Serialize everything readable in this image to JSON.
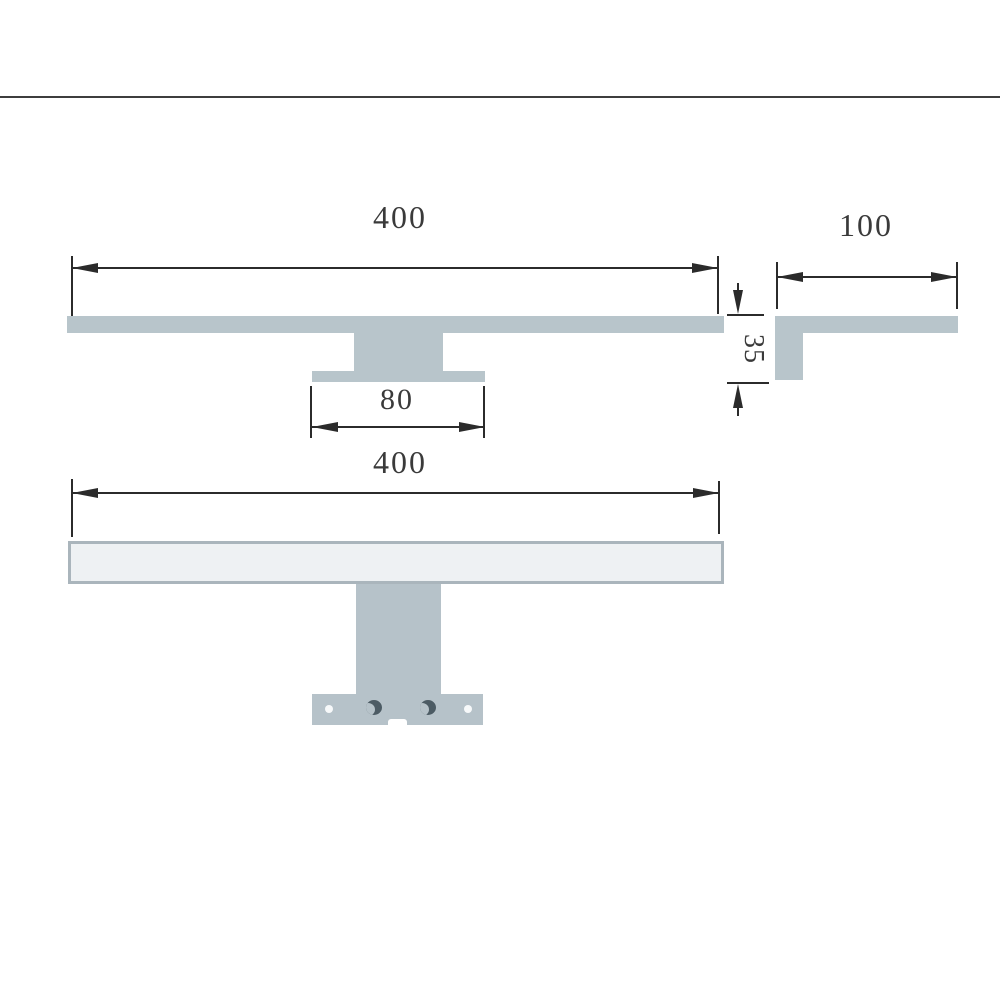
{
  "drawing": {
    "type": "technical-dimension-drawing",
    "subject": "wall mirror lamp profile and front views"
  },
  "dimensions": {
    "front_width": "400",
    "side_depth": "100",
    "profile_height": "35",
    "bracket_base_width": "80",
    "bottom_width": "400"
  },
  "colors": {
    "body_fill": "#b8c5cb",
    "bracket_fill": "#b6c2c9",
    "lamp_face_fill": "#eef1f3",
    "lamp_face_border": "#aab5bc",
    "dimension_line": "#2b2b2b",
    "text": "#3a3a3a",
    "slot_hole": "#4c5b64",
    "frame_line": "#3d3d3d"
  }
}
